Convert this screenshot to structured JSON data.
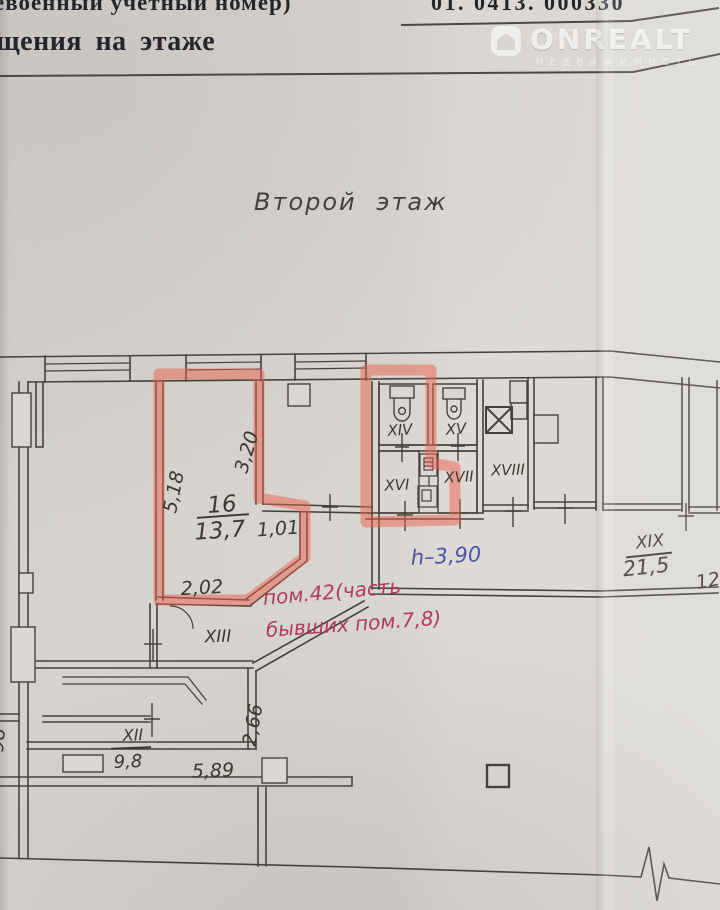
{
  "header": {
    "line1_fragment": "евоенный учетный номер)",
    "doc_number_fragment": "01. 0413. 000330",
    "line2_fragment": "щения на этаже"
  },
  "logo": {
    "brand": "ONREALT",
    "subtitle": "НЕДВИЖИМОСТЬ"
  },
  "plan": {
    "floor_title": "Второй этаж",
    "ink_color": "#46423b",
    "highlight_color": "#e9604a",
    "highlighted_room": {
      "number": "16",
      "area": "13,7"
    },
    "rooms": [
      {
        "label": "XII",
        "area": "9,8"
      },
      {
        "label": "XIII"
      },
      {
        "label": "XIV"
      },
      {
        "label": "XV"
      },
      {
        "label": "XVI"
      },
      {
        "label": "XVII"
      },
      {
        "label": "XVIII"
      },
      {
        "label": "XIX",
        "area": "21,5"
      }
    ],
    "dimensions": {
      "d5_18": "5,18",
      "d3_20": "3,20",
      "d1_01": "1,01",
      "d2_02": "2,02",
      "d2_66": "2,66",
      "d5_89": "5,89",
      "d12": "12",
      "edge_fragment": "98"
    },
    "annotations": {
      "height_note": "h–3,90",
      "height_note_color": "#4f52a6",
      "premise_note_line1": "пом.42(часть",
      "premise_note_line2": "бывших пом.7,8)",
      "premise_note_color": "#b13a5f"
    }
  }
}
